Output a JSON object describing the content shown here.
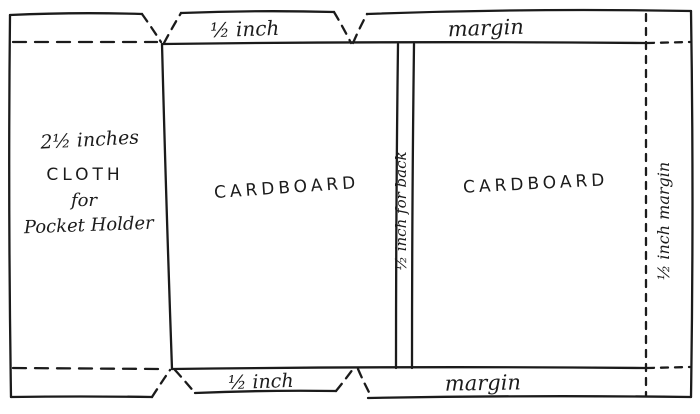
{
  "figure": {
    "ink_color": "#1b1b1b",
    "paper_color": "#ffffff"
  },
  "labels": {
    "top_middle_flap": "½ inch",
    "top_right_strip": "margin",
    "left_panel": {
      "line1": "2½ inches",
      "line2": "CLOTH",
      "line3": "for",
      "line4": "Pocket Holder"
    },
    "middle_panel": "CARDBOARD",
    "spine_strip": "½ inch for back",
    "right_panel": "CARDBOARD",
    "right_margin_strip": "½ inch margin",
    "bottom_middle_flap": "½ inch",
    "bottom_right_strip": "margin"
  }
}
